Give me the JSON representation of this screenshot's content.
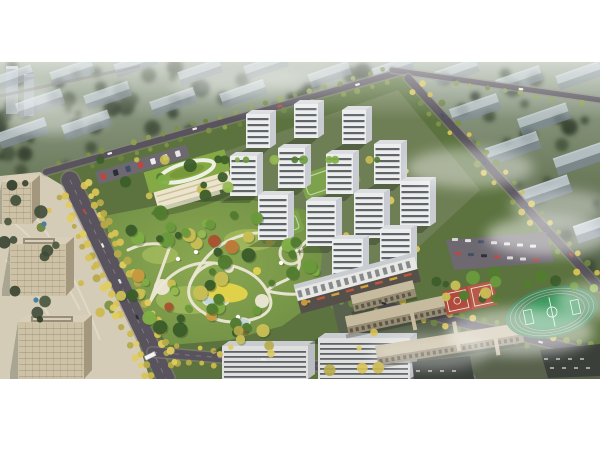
{
  "scene": {
    "strip_top": 62,
    "strip_height": 317,
    "colors": {
      "page_bg": "#ffffff",
      "bg_top": "#9aa795",
      "bg_mid": "#6e7c5e",
      "bg_low": "#505e46",
      "bg_deep": "#44503c",
      "slab_roof": "#c5cfdb",
      "slab_face": "#7f8b98",
      "slab_hi": "#e3ebf3",
      "bg_tower": "#a8b2bc",
      "road": "#58535c",
      "road_bg": "#6b6670",
      "road_edge": "#8a8580",
      "road_dash": "#a5a1ab",
      "site_green": "#5c7340",
      "towers_ground": "#6f7f55",
      "park_in": "#8aa851",
      "park_out": "#6d8c43",
      "lawn": "#a9bf60",
      "path": "#ece7d5",
      "pond": "#c3d6d8",
      "playground": "#e5d44b",
      "pavilion": "#ffffff",
      "tower_face": "#eceded",
      "tower_side": "#c9cdd3",
      "tower_win": "#474c54",
      "tower_roof": "#dbdde0",
      "tower_shadow": "rgba(35,45,35,0.35)",
      "kg_body": "#ece4cc",
      "kg_roof": "#85a944",
      "kg_roof_in": "#769739",
      "kg_ring": "#eef0e6",
      "office": "#cdc1a6",
      "office_side": "#a3977d",
      "office_win": "#6b6252",
      "office_roof": "#d9cfb8",
      "plaza": "#d5ccb8",
      "plaza_path": "#e4dcc8",
      "canopy_blue": "#4a7fa0",
      "retail_face": "#e7e7e3",
      "retail_base": "#55504a",
      "awning_a": "#c4553a",
      "awning_b": "#d8a13e",
      "bslab_face": "#dfe0de",
      "bslab_side": "#b9bdc2",
      "bslab_roof": "#c9ccd0",
      "campus": "#c6bb9f",
      "campus_side": "#978c74",
      "campus_win": "#4e473d",
      "campus_ground": "#57614b",
      "lot_dark": "#3a3f3a",
      "parking": "#6e6871",
      "court_red": "#b04a3c",
      "court_red2": "#b85948",
      "court_line": "#e8e4da",
      "field_track": "#48875a",
      "field_lane": "#dfe8df",
      "field_pitch": "#36975a",
      "field_line": "#eaf2ea",
      "fog": "#ffffff",
      "bus": "#f4f4f4"
    },
    "palettes": {
      "bg_trees": [
        "#36432f",
        "#3e4c37",
        "#46553d",
        "#2f3b2a"
      ],
      "park_trees": [
        "#3c5d2a",
        "#527c30",
        "#6a9a3c",
        "#80ae45",
        "#95ba52",
        "#c8bf55"
      ],
      "accent_trees": [
        "#bf7a38",
        "#a8542f",
        "#c89a40"
      ],
      "street_yellow": [
        "#d9c355",
        "#cdb94e",
        "#b7aa4a",
        "#e0cc60"
      ],
      "street_green": [
        "#7e9146",
        "#6d8440",
        "#8fa04e"
      ],
      "street_mixed": [
        "#7e9146",
        "#d9c355",
        "#6d8440",
        "#cdb94e"
      ],
      "cars": [
        "#eeeeee",
        "#c0463d",
        "#3e4e66",
        "#dddddd",
        "#2a2f36",
        "#e8e8e8"
      ]
    },
    "background": {
      "slabs": [
        [
          -8,
          86,
          0.8
        ],
        [
          52,
          80,
          0.8
        ],
        [
          116,
          72,
          0.78
        ],
        [
          180,
          80,
          0.8
        ],
        [
          246,
          74,
          0.8
        ],
        [
          310,
          82,
          0.78
        ],
        [
          374,
          76,
          0.75
        ],
        [
          436,
          80,
          0.82
        ],
        [
          498,
          88,
          0.85
        ],
        [
          558,
          84,
          0.85
        ],
        [
          18,
          112,
          0.88
        ],
        [
          86,
          104,
          0.86
        ],
        [
          152,
          110,
          0.85
        ],
        [
          222,
          102,
          0.85
        ],
        [
          452,
          118,
          0.92
        ],
        [
          520,
          128,
          0.95
        ],
        [
          0,
          142,
          0.92
        ],
        [
          64,
          134,
          0.9
        ],
        [
          488,
          158,
          1.0
        ],
        [
          556,
          168,
          1.0
        ],
        [
          518,
          202,
          1.02
        ],
        [
          576,
          236,
          1.02
        ]
      ],
      "towers": [
        [
          6,
          66,
          12,
          48
        ],
        [
          24,
          74,
          10,
          42
        ]
      ],
      "far_road": [
        392,
        70,
        600,
        100
      ],
      "tree_count": 80
    },
    "site_polygon": "0,186 400,72 408,78 600,288 600,379 0,379",
    "towers_ground_quad": "224,152 398,90 480,190 340,320",
    "campus_ground": "330,295 600,345 600,379 350,379",
    "plaza_polygon": "0,176 40,172 70,190 96,210 150,379 0,379",
    "roads": [
      {
        "id": "road-north",
        "pts": [
          46,
          172,
          400,
          72
        ],
        "w": 6,
        "trees": {
          "step": 15,
          "offs": [
            6,
            -6
          ],
          "pal": "street_green",
          "r": 2.6
        },
        "cars": [
          0.18,
          0.42,
          0.66,
          0.88
        ]
      },
      {
        "id": "road-east-upper",
        "pts": [
          392,
          70,
          600,
          100
        ],
        "w": 5,
        "trees": {
          "step": 16,
          "offs": [
            5
          ],
          "pal": "street_green",
          "r": 2.4
        },
        "cars": [
          0.3,
          0.62
        ]
      },
      {
        "id": "road-east",
        "pts": [
          408,
          78,
          600,
          288
        ],
        "w": 7.5,
        "trees": {
          "step": 13,
          "offs": [
            7,
            -7
          ],
          "pal": "street_mixed",
          "r": 3.0
        },
        "cars": [
          0.18,
          0.4,
          0.62,
          0.85
        ]
      },
      {
        "id": "avenue-west",
        "pts": [
          70,
          180,
          166,
          379
        ],
        "w": 17,
        "trees": {
          "step": 11,
          "offs": [
            12,
            17,
            -12,
            -17
          ],
          "pal": "street_yellow",
          "r": 3.3
        },
        "cars": [
          0.15,
          0.34,
          0.52,
          0.7,
          0.88
        ]
      },
      {
        "id": "road-south",
        "pts": [
          152,
          352,
          470,
          379
        ],
        "w": 9,
        "trees": {
          "step": 12,
          "offs": [
            7,
            -7
          ],
          "pal": "street_yellow",
          "r": 3.0
        },
        "cars": [
          0.35,
          0.72
        ]
      },
      {
        "id": "road-campus",
        "pts": [
          330,
          292,
          600,
          355
        ],
        "w": 8,
        "trees": {
          "step": 12,
          "offs": [
            7,
            -7
          ],
          "pal": "street_mixed",
          "r": 3.0
        },
        "cars": [
          0.2,
          0.5,
          0.78
        ]
      }
    ],
    "towers": [
      [
        246,
        148,
        1
      ],
      [
        294,
        138,
        1
      ],
      [
        342,
        144,
        1
      ],
      [
        230,
        196,
        2
      ],
      [
        278,
        188,
        2
      ],
      [
        326,
        194,
        2
      ],
      [
        374,
        184,
        2
      ],
      [
        258,
        240,
        3
      ],
      [
        306,
        246,
        3
      ],
      [
        354,
        238,
        3
      ],
      [
        400,
        226,
        3
      ],
      [
        332,
        286,
        4
      ],
      [
        380,
        276,
        4
      ]
    ],
    "tower_rows": {
      "w": [
        0,
        24,
        27,
        30,
        31
      ],
      "h": [
        0,
        34,
        40,
        45,
        47
      ]
    },
    "courtyards": [
      [
        298,
        176,
        58,
        26
      ],
      [
        256,
        224,
        44,
        22
      ]
    ],
    "kindergarten": {
      "cx": 190,
      "cy": 182,
      "angle": -16
    },
    "offices": [
      {
        "x": 2,
        "y": 182,
        "w": 30,
        "h": 42,
        "ring": false
      },
      {
        "x": 10,
        "y": 244,
        "w": 56,
        "h": 52,
        "ring": true
      },
      {
        "x": 18,
        "y": 322,
        "w": 66,
        "h": 57,
        "ring": true
      }
    ],
    "canopies": [
      [
        44,
        224
      ],
      [
        58,
        256
      ],
      [
        36,
        300
      ]
    ],
    "park": {
      "polygon": "104,216 170,203 252,200 305,210 322,255 318,300 282,326 230,340 170,345 128,300",
      "paths": [
        "M150,302 Q174,260 214,263 Q254,266 267,291 Q279,311 254,319 Q224,327 204,313 Q184,301 190,284 Q196,268 214,263",
        "M190,284 Q208,242 248,234 Q284,228 296,250 Q306,270 286,280 Q270,287 267,291",
        "M128,250 Q148,240 170,246 Q160,274 150,302",
        "M267,291 Q298,298 316,290",
        "M296,250 Q310,240 318,226"
      ],
      "nodes": [
        [
          162,
          287,
          8
        ],
        [
          262,
          301,
          7
        ],
        [
          229,
          268,
          5
        ]
      ],
      "ring_node": [
        291,
        253,
        11
      ],
      "ponds": [
        [
          216,
          301,
          13,
          5.5
        ],
        [
          242,
          322,
          8,
          4
        ]
      ],
      "playground": "M206,289 Q219,279 237,285 Q252,290 246,298 Q235,305 217,301 Q205,297 206,289",
      "play_dot": [
        257,
        271,
        4
      ],
      "pavilions": [
        [
          178,
          259
        ],
        [
          238,
          317
        ],
        [
          281,
          263
        ],
        [
          196,
          252
        ]
      ],
      "tree_count": 60
    },
    "retail_slab": {
      "cx": 358,
      "cy": 286,
      "len": 124,
      "angle": -15
    },
    "bottom_slabs": [
      [
        222,
        346,
        86,
        33
      ],
      [
        318,
        338,
        92,
        41
      ]
    ],
    "campus_slabs": [
      [
        402,
        316,
        112,
        11,
        -12
      ],
      [
        450,
        346,
        148,
        12,
        -9
      ],
      [
        384,
        298,
        64,
        9,
        -14
      ]
    ],
    "campus_corridors": [
      [
        408,
        305,
        4,
        26,
        -12
      ],
      [
        452,
        322,
        4,
        30,
        -10
      ],
      [
        492,
        330,
        4,
        26,
        -10
      ]
    ],
    "dark_lots": [
      "540,350 600,344 600,376 548,378",
      "412,362 470,356 474,379 414,379"
    ],
    "parking_lot": {
      "quad": "446,240 546,232 554,262 454,270",
      "rows": 2,
      "cols": 7
    },
    "parking_strip": {
      "x": 95,
      "y": 158,
      "w": 95,
      "h": 13,
      "angle": -17,
      "cars": 7
    },
    "courts": {
      "cx": 470,
      "cy": 298,
      "angle": -12
    },
    "field": {
      "cx": 552,
      "cy": 312,
      "rx": 47,
      "ry": 25,
      "angle": -12
    },
    "bus": {
      "x": 150,
      "y": 356,
      "angle": 64
    },
    "fog": [
      [
        55,
        118,
        52,
        16,
        0.4
      ],
      [
        240,
        84,
        70,
        12,
        0.28
      ],
      [
        470,
        168,
        64,
        20,
        0.42
      ],
      [
        548,
        236,
        62,
        20,
        0.5
      ],
      [
        560,
        206,
        50,
        16,
        0.4
      ],
      [
        520,
        332,
        74,
        24,
        0.5
      ],
      [
        596,
        300,
        40,
        18,
        0.4
      ],
      [
        20,
        96,
        40,
        12,
        0.38
      ],
      [
        300,
        76,
        50,
        9,
        0.22
      ],
      [
        430,
        352,
        60,
        18,
        0.35
      ]
    ]
  }
}
